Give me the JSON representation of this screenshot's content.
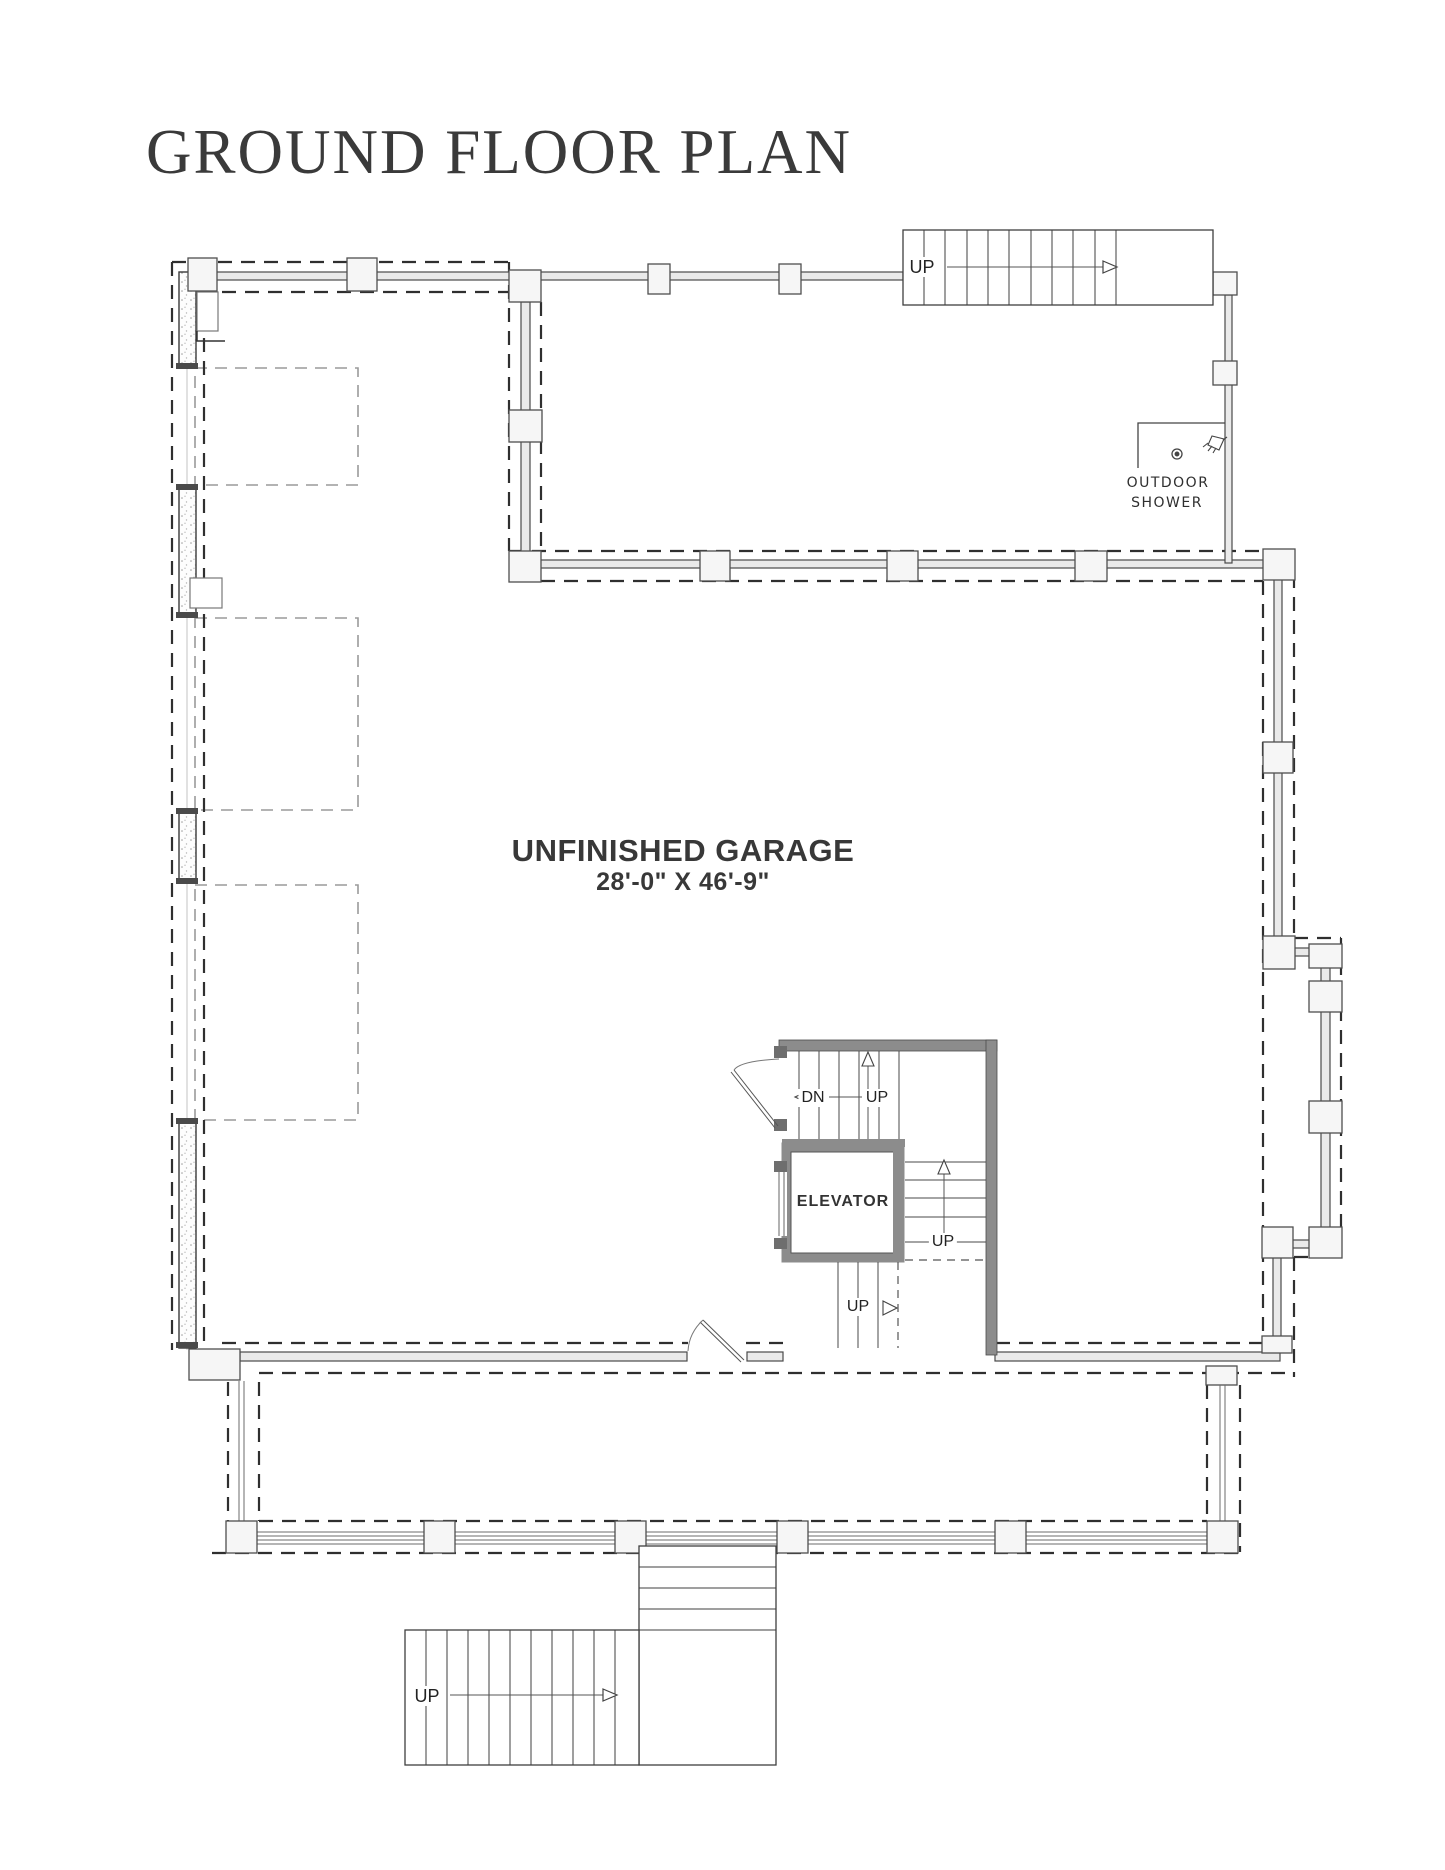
{
  "title": "GROUND FLOOR PLAN",
  "plan": {
    "room": {
      "name": "UNFINISHED GARAGE",
      "dimensions": "28'-0\" X 46'-9\""
    },
    "core": {
      "elevator_label": "ELEVATOR",
      "stair_down_label": "DN",
      "stair_up_label": "UP",
      "mid_flight_up_label": "UP",
      "lower_flight_up_label": "UP"
    },
    "outdoor_shower": {
      "line1": "OUTDOOR",
      "line2": "SHOWER"
    },
    "top_stair": {
      "up_label": "UP"
    },
    "entry_stair": {
      "up_label": "UP"
    },
    "colors": {
      "ink": "#3a3a3a",
      "wall_fill": "#eaeaea",
      "core_wall": "#8c8c8c",
      "interior_dashed": "#9a9a9a"
    }
  }
}
